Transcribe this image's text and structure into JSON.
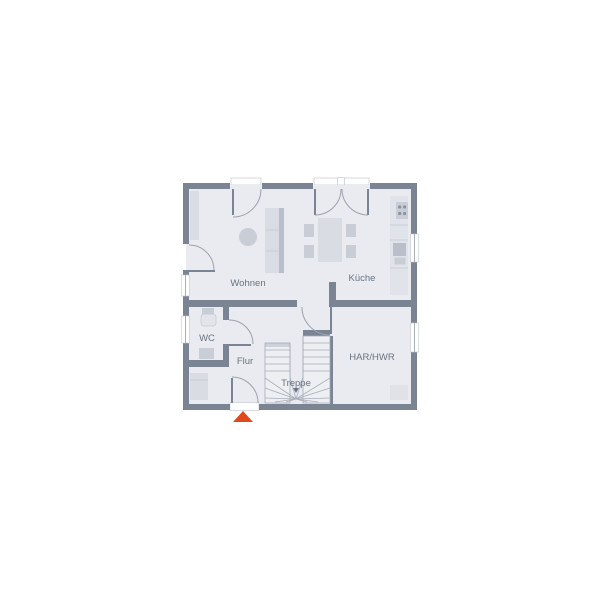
{
  "type": "floor-plan",
  "rooms": {
    "wohnen": {
      "label": "Wohnen"
    },
    "kueche": {
      "label": "Küche"
    },
    "wc": {
      "label": "WC"
    },
    "flur": {
      "label": "Flur"
    },
    "treppe": {
      "label": "Treppe"
    },
    "hwr": {
      "label": "HAR/HWR"
    }
  },
  "markers": {
    "entrance_arrow": {
      "description": "orange triangle below entrance door pointing up",
      "color": "#e0491c"
    }
  },
  "colors": {
    "wall": "#7b8492",
    "floor": "#e9ebf0",
    "furniture-light": "#d9dce3",
    "furniture-mid": "#c9cdd6",
    "furniture-dark": "#b9bfca",
    "counter": "#e0e3e9",
    "stair": "#edeff3",
    "arc": "#9ba2ae",
    "window-line": "#aab0bb",
    "label": "#6b7381",
    "accent": "#e0491c",
    "background": "#ffffff"
  }
}
